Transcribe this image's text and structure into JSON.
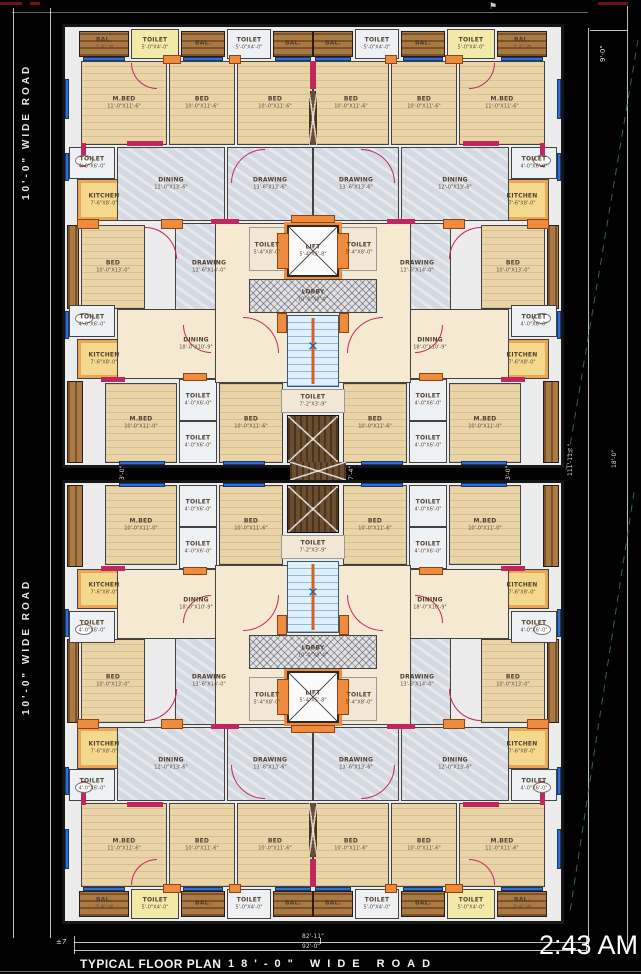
{
  "meta": {
    "time": "2:43 AM"
  },
  "footer": {
    "title": "TYPICAL FLOOR PLAN",
    "road": "18'-0\" WIDE ROAD"
  },
  "roads": {
    "left_top": "10'-0\" WIDE ROAD",
    "left_bottom": "10'-0\" WIDE ROAD"
  },
  "dims": {
    "right_top": "9'-0\"",
    "gap_left": "3'-0\"",
    "gap_mid": "7'-4\"",
    "gap_right": "3'-0\"",
    "right_bottom_a": "111'-11¾\"",
    "right_bottom_b": "18'-0\"",
    "bottom_a": "82'-11\"",
    "bottom_b": "92'-0\"",
    "bottom_left": "±7"
  },
  "icons": {
    "stair_cross": "✕",
    "flag": "⚑"
  },
  "colors": {
    "road_bg": "#000000",
    "wall_accent": "#c2265e",
    "column": "#f08a3c",
    "window": "#2e6fe0",
    "bed_floor": "#e9d4a8",
    "marble": "#d4d8e0",
    "living": "#f6e9d2",
    "kitchen": "#f3d88e",
    "balcony": "#a97a44",
    "stair": "#dff0fb",
    "text": "#ffffff"
  },
  "plan": {
    "block_w": 496,
    "block_h": 438,
    "rooms": [
      {
        "t": "balh",
        "s": "L",
        "x": 14,
        "y": 4,
        "w": 50,
        "h": 26,
        "label": "BAL.",
        "dims": "2'-6\" W"
      },
      {
        "t": "ty",
        "s": "L",
        "x": 66,
        "y": 2,
        "w": 48,
        "h": 30,
        "label": "TOILET",
        "dims": "5'-0\"X4'-0\""
      },
      {
        "t": "balh",
        "s": "L",
        "x": 116,
        "y": 4,
        "w": 44,
        "h": 26,
        "label": "BAL.",
        "dims": ""
      },
      {
        "t": "tw",
        "s": "L",
        "x": 162,
        "y": 2,
        "w": 44,
        "h": 30,
        "label": "TOILET",
        "dims": "5'-0\"X4'-0\""
      },
      {
        "t": "balh",
        "s": "L",
        "x": 208,
        "y": 4,
        "w": 40,
        "h": 26,
        "label": "BAL.",
        "dims": ""
      },
      {
        "t": "bed",
        "s": "L",
        "x": 16,
        "y": 34,
        "w": 86,
        "h": 84,
        "label": "M.BED",
        "dims": "11'-0\"X11'-6\""
      },
      {
        "t": "bed",
        "s": "L",
        "x": 104,
        "y": 34,
        "w": 66,
        "h": 84,
        "label": "BED",
        "dims": "10'-0\"X11'-6\""
      },
      {
        "t": "bed",
        "s": "L",
        "x": 172,
        "y": 34,
        "w": 76,
        "h": 84,
        "label": "BED",
        "dims": "10'-0\"X11'-6\""
      },
      {
        "t": "tw",
        "s": "L",
        "x": 4,
        "y": 120,
        "w": 46,
        "h": 32,
        "label": "TOILET",
        "dims": "4'-0\"X6'-0\""
      },
      {
        "t": "kit",
        "s": "L",
        "x": 12,
        "y": 152,
        "w": 54,
        "h": 42,
        "label": "KITCHEN",
        "dims": "7'-6\"X8'-0\""
      },
      {
        "t": "marble",
        "s": "L",
        "x": 52,
        "y": 120,
        "w": 108,
        "h": 74,
        "label": "DINING",
        "dims": "12'-0\"X13'-6\""
      },
      {
        "t": "marble",
        "s": "L",
        "x": 162,
        "y": 120,
        "w": 86,
        "h": 74,
        "label": "DRAWING",
        "dims": "13'-6\"X13'-6\""
      },
      {
        "t": "balv",
        "s": "L",
        "x": 2,
        "y": 198,
        "w": 12,
        "h": 84,
        "label": "",
        "dims": ""
      },
      {
        "t": "bed",
        "s": "L",
        "x": 16,
        "y": 198,
        "w": 64,
        "h": 84,
        "label": "BED",
        "dims": "10'-0\"X13'-0\""
      },
      {
        "t": "marble",
        "s": "L",
        "x": 110,
        "y": 196,
        "w": 68,
        "h": 88,
        "label": "DRAWING",
        "dims": "13'-6\"X14'-0\""
      },
      {
        "t": "tw",
        "s": "L",
        "x": 4,
        "y": 278,
        "w": 46,
        "h": 32,
        "label": "TOILET",
        "dims": "4'-0\"X6'-0\""
      },
      {
        "t": "kit",
        "s": "L",
        "x": 12,
        "y": 312,
        "w": 54,
        "h": 40,
        "label": "KITCHEN",
        "dims": "7'-6\"X8'-0\""
      },
      {
        "t": "cream",
        "s": "L",
        "x": 52,
        "y": 282,
        "w": 158,
        "h": 70,
        "label": "DINING",
        "dims": "18'-0\"X10'-9\""
      },
      {
        "t": "balv",
        "s": "L",
        "x": 2,
        "y": 354,
        "w": 16,
        "h": 82,
        "label": "",
        "dims": ""
      },
      {
        "t": "bed",
        "s": "L",
        "x": 40,
        "y": 356,
        "w": 72,
        "h": 80,
        "label": "M.BED",
        "dims": "10'-0\"X11'-0\""
      },
      {
        "t": "tw",
        "s": "L",
        "x": 114,
        "y": 352,
        "w": 38,
        "h": 42,
        "label": "TOILET",
        "dims": "4'-0\"X6'-0\""
      },
      {
        "t": "tw",
        "s": "L",
        "x": 114,
        "y": 394,
        "w": 38,
        "h": 42,
        "label": "TOILET",
        "dims": "4'-0\"X6'-0\""
      },
      {
        "t": "bed",
        "s": "L",
        "x": 154,
        "y": 356,
        "w": 64,
        "h": 80,
        "label": "BED",
        "dims": "10'-0\"X11'-6\""
      },
      {
        "t": "cream",
        "s": "C",
        "x": 150,
        "y": 196,
        "w": 196,
        "h": 160,
        "label": "",
        "dims": ""
      },
      {
        "t": "plain",
        "s": "C",
        "x": 184,
        "y": 200,
        "w": 36,
        "h": 44,
        "label": "TOILET",
        "dims": "5'-4\"X8'-0\""
      },
      {
        "t": "plain",
        "s": "C",
        "x": 276,
        "y": 200,
        "w": 36,
        "h": 44,
        "label": "TOILET",
        "dims": "5'-4\"X8'-0\""
      },
      {
        "t": "lift",
        "s": "C",
        "x": 222,
        "y": 198,
        "w": 52,
        "h": 52,
        "label": "LIFT",
        "dims": "5'-4\"X5'-8\""
      },
      {
        "t": "lobby",
        "s": "C",
        "x": 184,
        "y": 252,
        "w": 128,
        "h": 34,
        "label": "LOBBY",
        "dims": "10'-0\"X8'-0\""
      },
      {
        "t": "stair",
        "s": "C",
        "x": 222,
        "y": 288,
        "w": 52,
        "h": 72,
        "label": "",
        "dims": ""
      },
      {
        "t": "plain",
        "s": "C",
        "x": 216,
        "y": 362,
        "w": 64,
        "h": 24,
        "label": "TOILET",
        "dims": "7'-2\"X3'-9\""
      },
      {
        "t": "duct",
        "s": "C",
        "x": 222,
        "y": 388,
        "w": 52,
        "h": 48,
        "label": "",
        "dims": ""
      }
    ],
    "decor": [
      {
        "t": "win",
        "s": "L",
        "x": 18,
        "y": 30,
        "w": 42,
        "h": 4
      },
      {
        "t": "win",
        "s": "L",
        "x": 118,
        "y": 30,
        "w": 40,
        "h": 4
      },
      {
        "t": "win",
        "s": "L",
        "x": 210,
        "y": 30,
        "w": 36,
        "h": 4
      },
      {
        "t": "win",
        "s": "L",
        "x": 0,
        "y": 52,
        "w": 4,
        "h": 40
      },
      {
        "t": "win",
        "s": "L",
        "x": 0,
        "y": 126,
        "w": 4,
        "h": 28
      },
      {
        "t": "win",
        "s": "L",
        "x": 0,
        "y": 284,
        "w": 4,
        "h": 28
      },
      {
        "t": "win",
        "s": "L",
        "x": 54,
        "y": 434,
        "w": 46,
        "h": 4
      },
      {
        "t": "win",
        "s": "L",
        "x": 158,
        "y": 434,
        "w": 42,
        "h": 4
      },
      {
        "t": "col",
        "s": "L",
        "x": 98,
        "y": 28,
        "w": 18,
        "h": 9
      },
      {
        "t": "col",
        "s": "L",
        "x": 164,
        "y": 28,
        "w": 12,
        "h": 9
      },
      {
        "t": "col",
        "s": "L",
        "x": 12,
        "y": 192,
        "w": 22,
        "h": 10
      },
      {
        "t": "col",
        "s": "L",
        "x": 96,
        "y": 192,
        "w": 22,
        "h": 10
      },
      {
        "t": "col",
        "s": "L",
        "x": 118,
        "y": 346,
        "w": 24,
        "h": 8
      },
      {
        "t": "col",
        "s": "C",
        "x": 212,
        "y": 206,
        "w": 12,
        "h": 36
      },
      {
        "t": "col",
        "s": "C",
        "x": 272,
        "y": 206,
        "w": 12,
        "h": 36
      },
      {
        "t": "col",
        "s": "C",
        "x": 212,
        "y": 286,
        "w": 10,
        "h": 20
      },
      {
        "t": "col",
        "s": "C",
        "x": 274,
        "y": 286,
        "w": 10,
        "h": 20
      },
      {
        "t": "col",
        "s": "C",
        "x": 226,
        "y": 188,
        "w": 44,
        "h": 8
      },
      {
        "t": "wall",
        "s": "L",
        "x": 62,
        "y": 114,
        "w": 36,
        "h": 5
      },
      {
        "t": "wall",
        "s": "L",
        "x": 146,
        "y": 192,
        "w": 28,
        "h": 5
      },
      {
        "t": "wall",
        "s": "L",
        "x": 36,
        "y": 350,
        "w": 24,
        "h": 5
      },
      {
        "t": "wall",
        "s": "L",
        "x": 246,
        "y": 34,
        "w": 5,
        "h": 28
      },
      {
        "t": "wall",
        "s": "L",
        "x": 16,
        "y": 116,
        "w": 5,
        "h": 24
      },
      {
        "t": "duct",
        "s": "L",
        "x": 244,
        "y": 64,
        "w": 8,
        "h": 54
      },
      {
        "t": "arc",
        "s": "L",
        "x": 166,
        "y": 122,
        "w": 34,
        "h": 34,
        "c": "tl"
      },
      {
        "t": "arc",
        "s": "L",
        "x": 80,
        "y": 200,
        "w": 32,
        "h": 32,
        "c": "tr"
      },
      {
        "t": "arc",
        "s": "L",
        "x": 178,
        "y": 290,
        "w": 36,
        "h": 36,
        "c": "tr"
      },
      {
        "t": "arc",
        "s": "L",
        "x": 118,
        "y": 298,
        "w": 28,
        "h": 28,
        "c": "bl"
      },
      {
        "t": "arc",
        "s": "L",
        "x": 66,
        "y": 36,
        "w": 26,
        "h": 26,
        "c": "bl"
      },
      {
        "t": "wc",
        "s": "L",
        "x": 10,
        "y": 128,
        "w": 18,
        "h": 11
      },
      {
        "t": "wc",
        "s": "L",
        "x": 10,
        "y": 286,
        "w": 18,
        "h": 11
      }
    ]
  }
}
